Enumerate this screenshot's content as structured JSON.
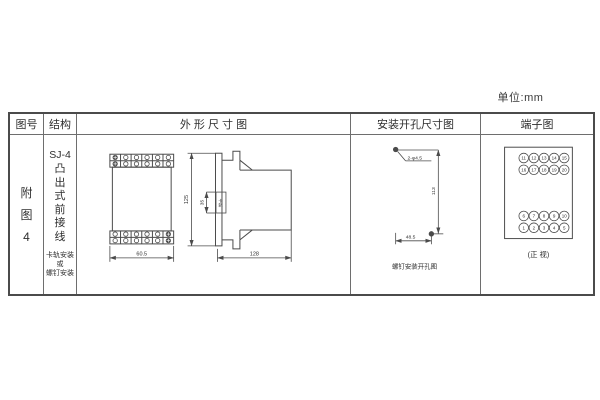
{
  "unit_label": "单位:mm",
  "table": {
    "headers": {
      "figure_no": "图号",
      "structure": "结构",
      "outline": "外 形 尺 寸 图",
      "mounting": "安装开孔尺寸图",
      "terminal": "端子图"
    }
  },
  "figure": {
    "label": "附\n图\n4"
  },
  "structure": {
    "model": "SJ-4",
    "type_vertical": "凸\n出\n式\n前\n接\n线",
    "mounting_note": "卡轨安装\n或\n螺钉安装"
  },
  "outline": {
    "front_width": "60.5",
    "height": "125",
    "rail_dim": "35",
    "rail_label": "卡轨",
    "depth": "128"
  },
  "mounting": {
    "hole_label": "2-φ4.5",
    "vertical_dim": "113",
    "horizontal_dim": "48.5",
    "caption": "螺钉安装开孔图"
  },
  "terminal": {
    "top_rows": [
      [
        "11",
        "12",
        "13",
        "14",
        "15"
      ],
      [
        "16",
        "17",
        "18",
        "19",
        "20"
      ]
    ],
    "bottom_rows": [
      [
        "6",
        "7",
        "8",
        "9",
        "10"
      ],
      [
        "1",
        "2",
        "3",
        "4",
        "5"
      ]
    ],
    "caption": "(正 视)"
  },
  "colors": {
    "line": "#4b4b4b",
    "grid": "#6e6e6e",
    "text": "#2e2e2e"
  }
}
